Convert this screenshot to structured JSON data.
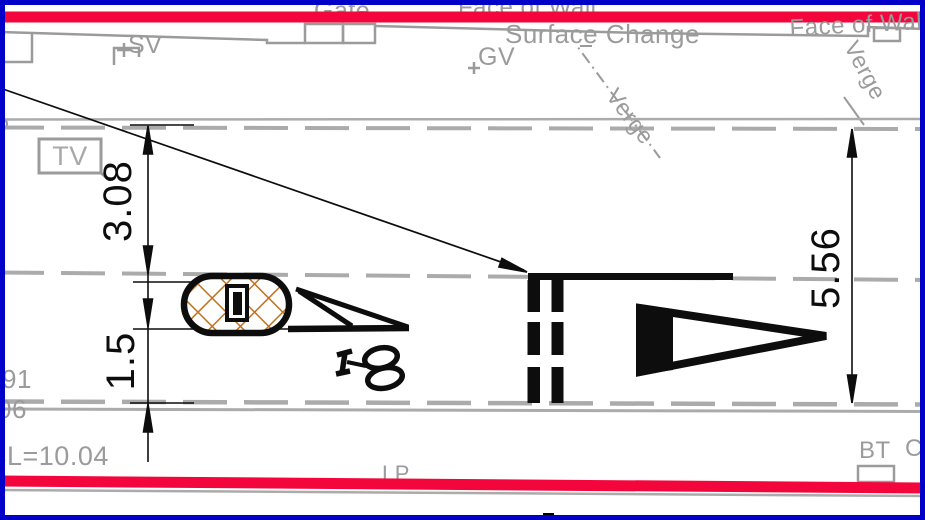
{
  "drawing": {
    "type": "cad-highway-plan-view",
    "annotations": {
      "gate": "Gate",
      "face_of_wall_top": "Face of Wall",
      "face_of_wall_right": "Face of Wall",
      "surface_change": "Surface Change",
      "verge_mid": "Verge",
      "verge_right": "Verge"
    },
    "utilities": {
      "tv": "TV",
      "sv": "SV",
      "gv": "GV",
      "lp": "LP",
      "bt": "BT",
      "c_partial": "C"
    },
    "levels": {
      "level_note": "CL=10.04",
      "partial_91": "91",
      "partial_06": "06"
    },
    "dimensions": {
      "left_upper": "3.08",
      "left_lower": "1.5",
      "right": "5.56"
    },
    "colors": {
      "kerb_red": "#f2063c",
      "border_blue": "#0000c8",
      "hatch_orange": "#c2711d",
      "line_gray": "#9b9b9b",
      "lane_gray": "#ababab",
      "marking_black": "#0d0d0d"
    }
  }
}
